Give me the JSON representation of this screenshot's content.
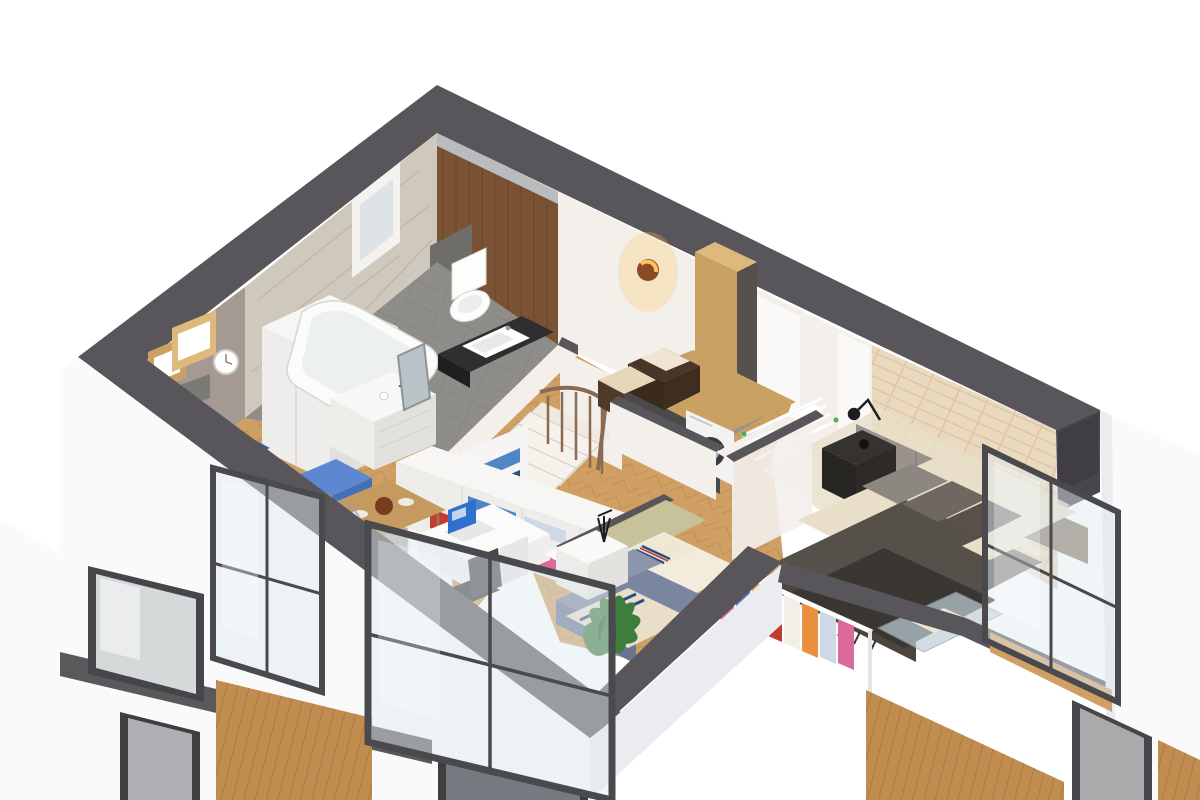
{
  "canvas": {
    "width": 1200,
    "height": 800
  },
  "scene": {
    "type": "isometric-cutaway-floorplan-render",
    "floor_shown": "upper-floor-dollhouse-view",
    "rooms": [
      {
        "id": "living-corner",
        "features": [
          "blue-sofa",
          "wood-cube-shelves",
          "wall-clock",
          "gray-wall-shelf",
          "white-wardrobe",
          "herringbone-parquet"
        ]
      },
      {
        "id": "bathroom",
        "features": [
          "bathtub",
          "wall-hung-toilet",
          "washbasin-on-dark-counter",
          "marble-tile-wall",
          "small-window",
          "walnut-wall-cabinets",
          "gray-tile-floor",
          "white-dresser",
          "leaning-mirror"
        ]
      },
      {
        "id": "hallway",
        "features": [
          "wooden-staircase",
          "stair-railing",
          "open-white-door",
          "folded-clothes-shelf"
        ]
      },
      {
        "id": "laundry-room",
        "features": [
          "wood-countertop",
          "washing-machine",
          "dark-storage-boxes",
          "towels",
          "tall-oak-cabinet",
          "copper-wall-sconce",
          "drying-rack"
        ]
      },
      {
        "id": "master-bedroom",
        "features": [
          "brick-accent-wall",
          "tufted-headboard-panels",
          "double-bed",
          "dark-duvet",
          "fringed-throw",
          "pillows",
          "black-reading-lamp",
          "dark-nightstand",
          "open-clothes-rail",
          "glass-display-unit",
          "balcony-glazing"
        ]
      },
      {
        "id": "kids-bedroom",
        "features": [
          "sage-headboard-wall",
          "single-bed",
          "striped-bedding",
          "white-nightstand",
          "tripod-lamp",
          "potted-plant"
        ]
      },
      {
        "id": "dressing-office",
        "features": [
          "open-shelving-unit",
          "folded-blue-clothes",
          "colorful-handbags",
          "white-desk",
          "laptop-blue-screen",
          "dark-office-chair",
          "wood-dining-table",
          "ghost-chair",
          "speckled-area-rug",
          "balcony-glazing"
        ]
      }
    ],
    "exterior": [
      "white-render-facade",
      "charcoal-wall-caps",
      "charcoal-floor-slab-band",
      "wood-slat-panels",
      "dark-framed-windows",
      "lower-floor-curtain-glazing"
    ]
  },
  "colors": {
    "capDark": "#59565b",
    "capDark2": "#48454b",
    "facade": "#fafafb",
    "facadeShade": "#ececf0",
    "wallWhite": "#f3f0ec",
    "wallWhite2": "#fbf9f7",
    "taupe": "#a49a93",
    "taupeDark": "#8e857f",
    "marble": "#cfc8bc",
    "marbleStreak": "#bab1a2",
    "walnut": "#7b5233",
    "walnutDark": "#5e3d24",
    "oak": "#c9a163",
    "oakLight": "#ddb97d",
    "parquet": "#cf9f63",
    "parquetLine": "#b9854b",
    "grayFloor": "#8e8d89",
    "grayFloorLine": "#80807c",
    "laundryFloor": "#97958e",
    "blueSofa": "#4470b8",
    "blueSofaLight": "#5d87d0",
    "blueSofaDark": "#395fa2",
    "brick": "#ead9bf",
    "brickLine": "#d8c2a1",
    "headboardGray": "#99938c",
    "headboardBrown": "#897767",
    "duvet": "#56504b",
    "throw": "#3a3733",
    "sheet": "#e9dec8",
    "greenWall": "#c8c29a",
    "plant": "#3e7d3c",
    "plantDark": "#2f5f2e",
    "copper": "#8a4a26",
    "glow": "#ffc35e",
    "glass": "#dfeaf0",
    "frame": "#4a4a4e",
    "rug": "#b6b0a7",
    "rugLight": "#cac4bb",
    "woodPanel": "#c08c4f",
    "woodPanelLine": "#a87640",
    "darkFurn": "#3c3c3f",
    "clothRed": "#c23b2e",
    "clothYellow": "#e0b33a",
    "clothPink": "#d96a9a",
    "clothBlue": "#4f86c6",
    "clothOrange": "#e98f3e",
    "clothNavy": "#2b4d8f",
    "screenBlue": "#2f6fd0"
  }
}
